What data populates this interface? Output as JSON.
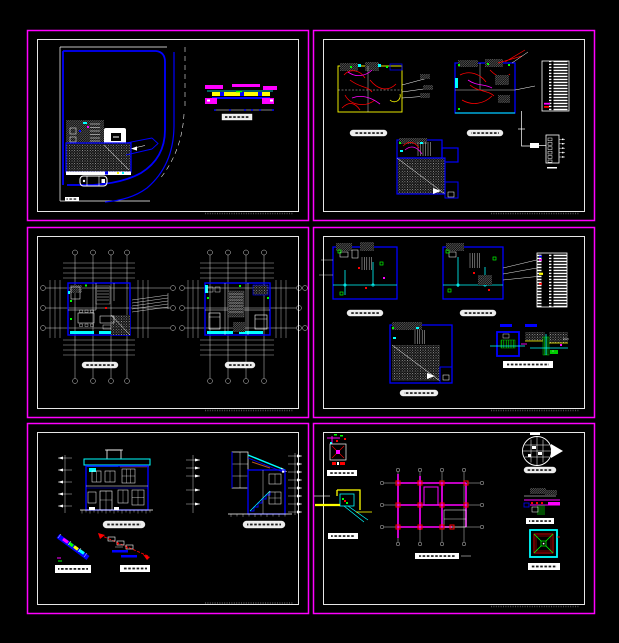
{
  "canvas": {
    "width": 619,
    "height": 643,
    "background": "#000000"
  },
  "palette": {
    "sheet_border": "#ff00ff",
    "sheet_frame": "#ffffff",
    "wall_lines": "#0000ff",
    "pipe_lines": "#00ffff",
    "wiring_lines": "#ff0000",
    "beam_lines": "#ff00ff",
    "detail_lines": "#ffff00",
    "marker_dots": "#00ff00",
    "hatch_gray": "#9a9a9a",
    "roof_accent": "#b4551e",
    "background": "#000000"
  },
  "layout": {
    "rows": 3,
    "columns": 2,
    "sheet_width": 282,
    "sheet_height": 191
  },
  "sheets": [
    {
      "id": "sheet-1",
      "position": "top-left",
      "title": "site-plan-sheet",
      "contents": [
        "site boundary with curved access road",
        "building footprint block",
        "hatched roof terrace",
        "parked car symbol",
        "road cross-section detail with dimension line",
        "illegible title labels"
      ]
    },
    {
      "id": "sheet-2",
      "position": "top-right",
      "title": "electrical-plans-sheet",
      "contents": [
        "ground floor electrical plan with red wiring",
        "second floor electrical plan with red wiring",
        "symbol legend table",
        "distribution panel riser diagram",
        "basement electrical plan",
        "illegible title labels"
      ]
    },
    {
      "id": "sheet-3",
      "position": "middle-left",
      "title": "floor-plans-sheet",
      "contents": [
        "first floor furnished plan with grid bubbles and dimension strings",
        "second floor furnished plan with grid bubbles and dimension strings",
        "illegible title labels"
      ]
    },
    {
      "id": "sheet-4",
      "position": "middle-right",
      "title": "plumbing-plans-sheet",
      "contents": [
        "ground floor plumbing plan",
        "second floor plumbing plan",
        "plumbing legend table",
        "basement plumbing plan",
        "water tank and trench section detail",
        "illegible title labels"
      ]
    },
    {
      "id": "sheet-5",
      "position": "bottom-left",
      "title": "elevations-sections-sheet",
      "contents": [
        "front elevation with level arrows",
        "building section with stair",
        "stair flight detail",
        "stair step detail",
        "illegible title labels"
      ]
    },
    {
      "id": "sheet-6",
      "position": "bottom-right",
      "title": "structural-foundation-sheet",
      "contents": [
        "joint detail",
        "yellow bracket connection detail",
        "foundation beam plan with red columns",
        "circular roof drain detail",
        "wall footing section detail",
        "square pit plan detail",
        "illegible title labels"
      ]
    }
  ],
  "notes": {
    "text_legibility": "all drawing annotations are below legibility threshold and rendered as bar glyphs"
  }
}
